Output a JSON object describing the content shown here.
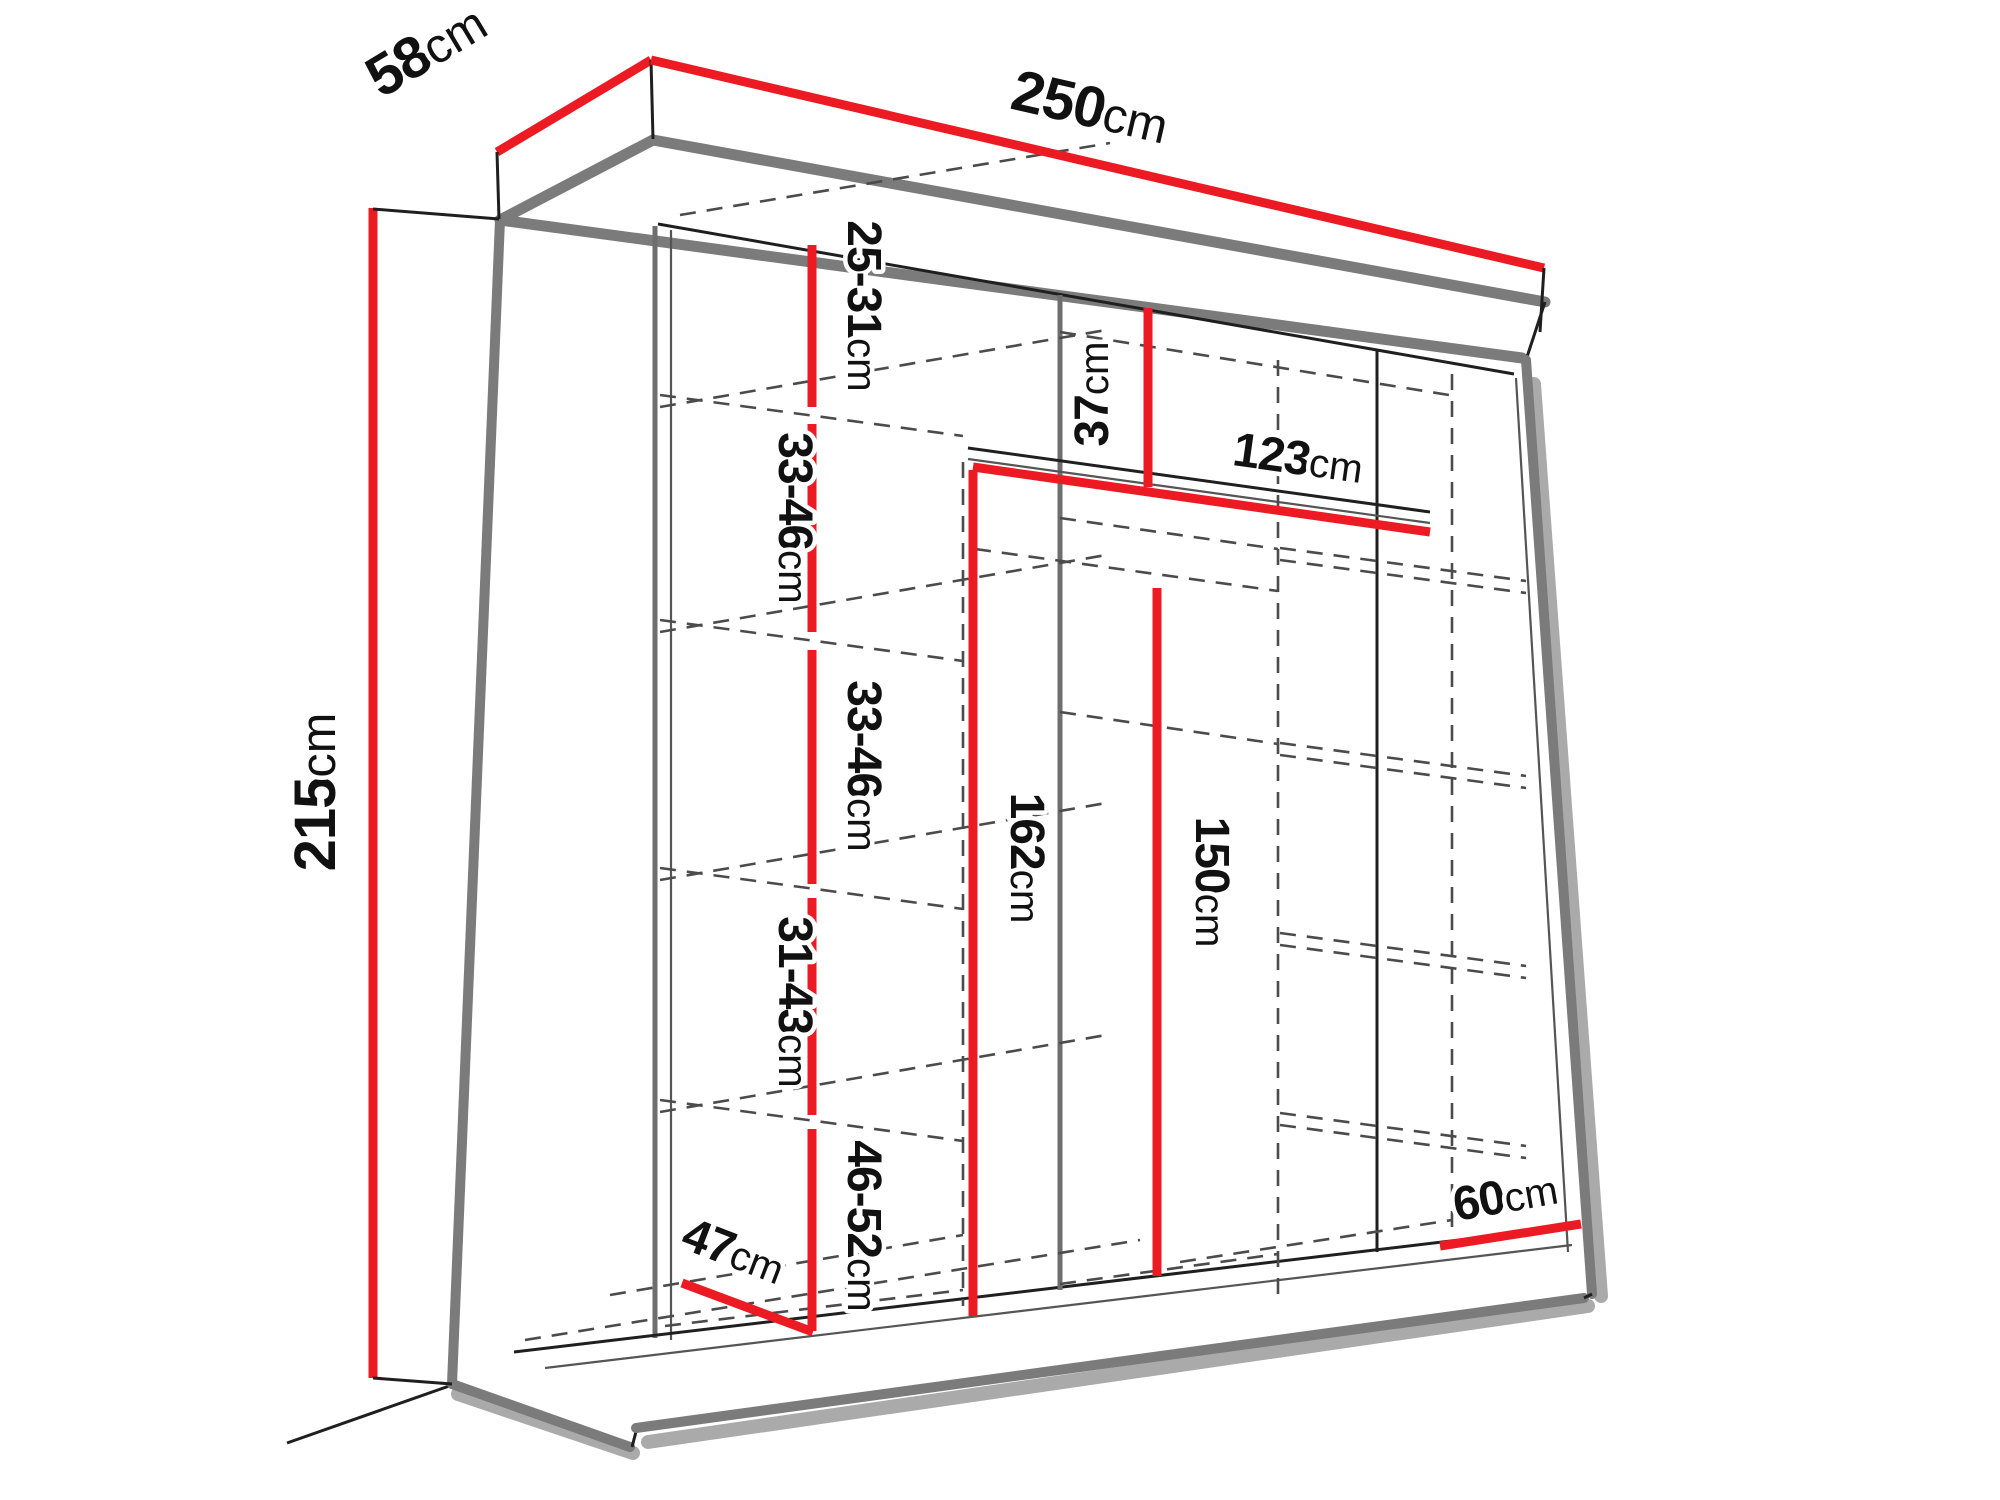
{
  "diagram": {
    "subject": "wardrobe-dimension-drawing",
    "unit": "cm",
    "colors": {
      "red": "#ec1b23",
      "outline": "#7b7b7b",
      "text": "#111111",
      "dashed": "#4b4b4b"
    }
  },
  "labels": {
    "depth": {
      "num": "58",
      "unit": "cm"
    },
    "width": {
      "num": "250",
      "unit": "cm"
    },
    "height": {
      "num": "215",
      "unit": "cm"
    },
    "shelf_top": {
      "num": "25-31",
      "unit": "cm"
    },
    "shelf_upper_a": {
      "num": "33-46",
      "unit": "cm"
    },
    "shelf_upper_b": {
      "num": "33-46",
      "unit": "cm"
    },
    "shelf_lower": {
      "num": "31-43",
      "unit": "cm"
    },
    "shelf_bottom": {
      "num": "46-52",
      "unit": "cm"
    },
    "floor_depth": {
      "num": "47",
      "unit": "cm"
    },
    "top_section": {
      "num": "37",
      "unit": "cm"
    },
    "rail_width": {
      "num": "123",
      "unit": "cm"
    },
    "mid_height": {
      "num": "162",
      "unit": "cm"
    },
    "hang_height": {
      "num": "150",
      "unit": "cm"
    },
    "right_width": {
      "num": "60",
      "unit": "cm"
    }
  }
}
